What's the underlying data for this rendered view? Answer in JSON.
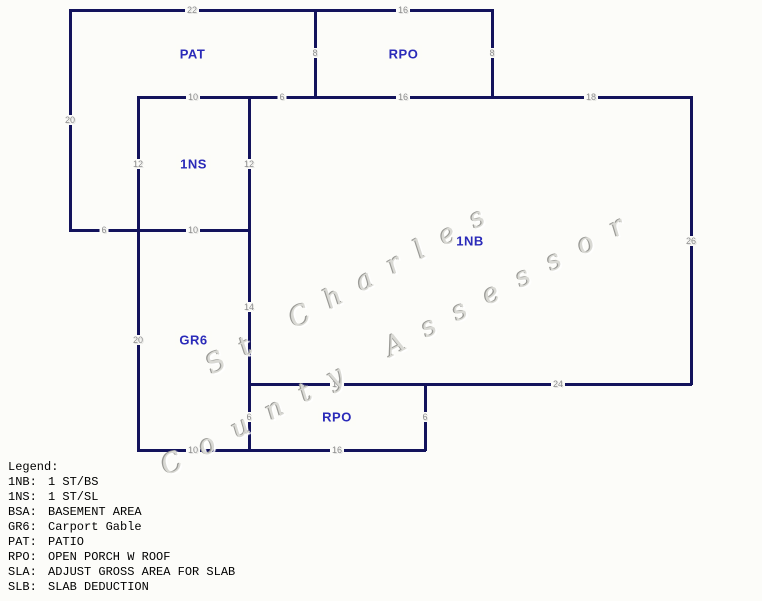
{
  "page": {
    "background": "#FCFCF9"
  },
  "diagram": {
    "wall_color": "#13135C",
    "area_label_color": "#2A2AB9",
    "dimension_color": "#8E8E8E",
    "areas": [
      {
        "id": "pat",
        "label": "PAT",
        "x": 70,
        "y": 10,
        "w": 245,
        "h": 87
      },
      {
        "id": "rpo-top",
        "label": "RPO",
        "x": 315,
        "y": 10,
        "w": 177,
        "h": 87
      },
      {
        "id": "1ns",
        "label": "1NS",
        "x": 138,
        "y": 97,
        "w": 111,
        "h": 133
      },
      {
        "id": "1nb",
        "label": "1NB",
        "x": 249,
        "y": 97,
        "w": 442,
        "h": 287
      },
      {
        "id": "gr6",
        "label": "GR6",
        "x": 138,
        "y": 230,
        "w": 111,
        "h": 220
      },
      {
        "id": "rpo-bottom",
        "label": "RPO",
        "x": 249,
        "y": 384,
        "w": 176,
        "h": 66
      }
    ],
    "walls": [
      {
        "dir": "h",
        "x": 70,
        "y": 10,
        "len": 245
      },
      {
        "dir": "h",
        "x": 315,
        "y": 10,
        "len": 177
      },
      {
        "dir": "h",
        "x": 138,
        "y": 97,
        "len": 553
      },
      {
        "dir": "h",
        "x": 70,
        "y": 230,
        "len": 179
      },
      {
        "dir": "h",
        "x": 249,
        "y": 384,
        "len": 442
      },
      {
        "dir": "h",
        "x": 138,
        "y": 450,
        "len": 287
      },
      {
        "dir": "v",
        "x": 70,
        "y": 10,
        "len": 220
      },
      {
        "dir": "v",
        "x": 138,
        "y": 97,
        "len": 353
      },
      {
        "dir": "v",
        "x": 249,
        "y": 97,
        "len": 353
      },
      {
        "dir": "v",
        "x": 315,
        "y": 10,
        "len": 87
      },
      {
        "dir": "v",
        "x": 492,
        "y": 10,
        "len": 87
      },
      {
        "dir": "v",
        "x": 691,
        "y": 97,
        "len": 287
      },
      {
        "dir": "v",
        "x": 425,
        "y": 384,
        "len": 66
      }
    ],
    "dimensions": [
      {
        "t": "22",
        "x": 192,
        "y": 10
      },
      {
        "t": "16",
        "x": 403,
        "y": 10
      },
      {
        "t": "8",
        "x": 315,
        "y": 53
      },
      {
        "t": "8",
        "x": 492,
        "y": 53
      },
      {
        "t": "10",
        "x": 193,
        "y": 97
      },
      {
        "t": "6",
        "x": 282,
        "y": 97
      },
      {
        "t": "16",
        "x": 403,
        "y": 97
      },
      {
        "t": "18",
        "x": 591,
        "y": 97
      },
      {
        "t": "20",
        "x": 70,
        "y": 120
      },
      {
        "t": "12",
        "x": 138,
        "y": 164
      },
      {
        "t": "12",
        "x": 249,
        "y": 164
      },
      {
        "t": "6",
        "x": 104,
        "y": 230
      },
      {
        "t": "10",
        "x": 193,
        "y": 230
      },
      {
        "t": "26",
        "x": 691,
        "y": 241
      },
      {
        "t": "14",
        "x": 249,
        "y": 307
      },
      {
        "t": "20",
        "x": 138,
        "y": 340
      },
      {
        "t": "16",
        "x": 337,
        "y": 384
      },
      {
        "t": "24",
        "x": 558,
        "y": 384
      },
      {
        "t": "6",
        "x": 249,
        "y": 417
      },
      {
        "t": "6",
        "x": 425,
        "y": 417
      },
      {
        "t": "10",
        "x": 193,
        "y": 450
      },
      {
        "t": "16",
        "x": 337,
        "y": 450
      }
    ]
  },
  "watermark": {
    "line1": "St Charles",
    "line2": "County Assessor"
  },
  "legend": {
    "title": "Legend:",
    "entries": [
      {
        "code": "1NB:",
        "desc": "1 ST/BS"
      },
      {
        "code": "1NS:",
        "desc": "1 ST/SL"
      },
      {
        "code": "BSA:",
        "desc": "BASEMENT AREA"
      },
      {
        "code": "GR6:",
        "desc": "Carport Gable"
      },
      {
        "code": "PAT:",
        "desc": "PATIO"
      },
      {
        "code": "RPO:",
        "desc": "OPEN PORCH W ROOF"
      },
      {
        "code": "SLA:",
        "desc": "ADJUST GROSS AREA FOR SLAB"
      },
      {
        "code": "SLB:",
        "desc": "SLAB DEDUCTION"
      }
    ]
  }
}
